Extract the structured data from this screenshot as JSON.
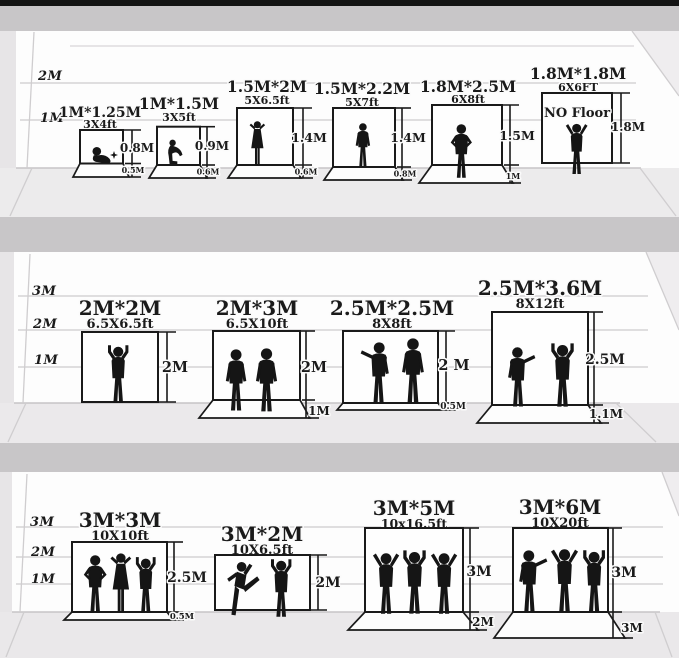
{
  "panels": [
    {
      "name": "row-1",
      "axis": [
        "2M",
        "1M"
      ],
      "items": [
        {
          "title": "1M*1.25M",
          "subtitle": "3X4ft",
          "height_label": "0.8M",
          "floor_label": "0.5M"
        },
        {
          "title": "1M*1.5M",
          "subtitle": "3X5ft",
          "height_label": "0.9M",
          "floor_label": "0.6M"
        },
        {
          "title": "1.5M*2M",
          "subtitle": "5X6.5ft",
          "height_label": "1.4M",
          "floor_label": "0.6M"
        },
        {
          "title": "1.5M*2.2M",
          "subtitle": "5X7ft",
          "height_label": "1.4M",
          "floor_label": "0.8M"
        },
        {
          "title": "1.8M*2.5M",
          "subtitle": "6X8ft",
          "height_label": "1.5M",
          "floor_label": "1M"
        },
        {
          "title": "1.8M*1.8M",
          "subtitle": "6X6FT",
          "height_label": "1.8M",
          "note": "NO Floor"
        }
      ]
    },
    {
      "name": "row-2",
      "axis": [
        "3M",
        "2M",
        "1M"
      ],
      "items": [
        {
          "title": "2M*2M",
          "subtitle": "6.5X6.5ft",
          "height_label": "2M"
        },
        {
          "title": "2M*3M",
          "subtitle": "6.5X10ft",
          "height_label": "2M",
          "floor_label": "1M"
        },
        {
          "title": "2.5M*2.5M",
          "subtitle": "8X8ft",
          "height_label": "2 M",
          "floor_label": "0.5M"
        },
        {
          "title": "2.5M*3.6M",
          "subtitle": "8X12ft",
          "height_label": "2.5M",
          "floor_label": "1.1M"
        }
      ]
    },
    {
      "name": "row-3",
      "axis": [
        "3M",
        "2M",
        "1M"
      ],
      "items": [
        {
          "title": "3M*3M",
          "subtitle": "10X10ft",
          "height_label": "2.5M",
          "floor_label": "0.5M"
        },
        {
          "title": "3M*2M",
          "subtitle": "10X6.5ft",
          "height_label": "2M"
        },
        {
          "title": "3M*5M",
          "subtitle": "10x16.5ft",
          "height_label": "3M",
          "floor_label": "2M"
        },
        {
          "title": "3M*6M",
          "subtitle": "10X20ft",
          "height_label": "3M",
          "floor_label": "3M"
        }
      ]
    }
  ],
  "colors": {
    "background": "#e7e5e7",
    "wall": "#fdfdfd",
    "floor": "#ebe9eb",
    "divider": "#c8c6c8",
    "ink": "#1a1a1a",
    "grid": "#d5d3d5",
    "top_bar": "#141414"
  }
}
